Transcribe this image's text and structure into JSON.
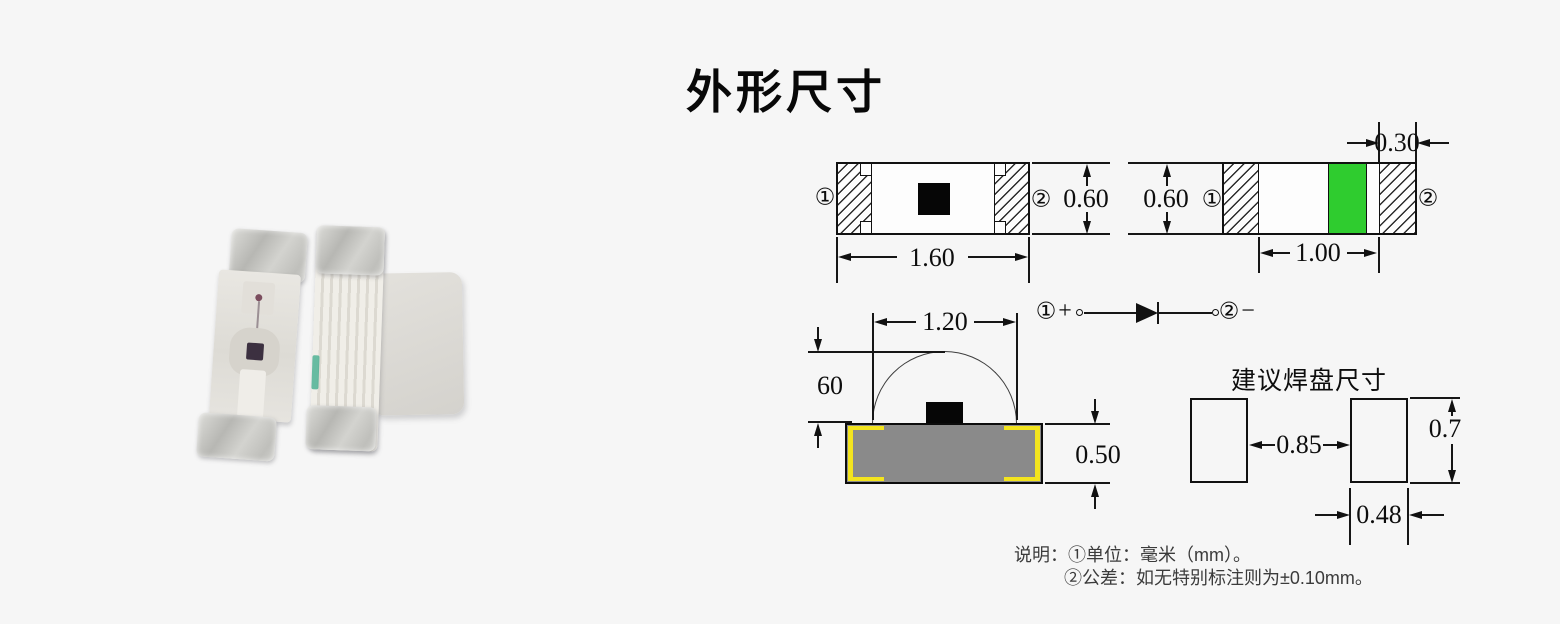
{
  "title": "外形尺寸",
  "views": {
    "top": {
      "pin1": "①",
      "pin2": "②",
      "width": "1.60",
      "height": "0.60"
    },
    "back": {
      "pin1": "①",
      "pin2": "②",
      "height": "0.60",
      "mark_width": "0.30",
      "inner_width": "1.00"
    },
    "side": {
      "dome_width": "1.20",
      "dome_height": "60",
      "body_height": "0.50"
    }
  },
  "polarity": {
    "pin1": "①",
    "plus": "+",
    "pin2": "②",
    "minus": "−"
  },
  "pads": {
    "title": "建议焊盘尺寸",
    "gap": "0.85",
    "height": "0.7",
    "width": "0.48"
  },
  "notes": {
    "line1": "说明：①单位：毫米（mm）。",
    "line2": "②公差：如无特别标注则为±0.10mm。"
  },
  "colors": {
    "green": "#2fcc2f",
    "body_gray": "#8a8a8a",
    "electrode_yellow": "#f3e41e"
  }
}
